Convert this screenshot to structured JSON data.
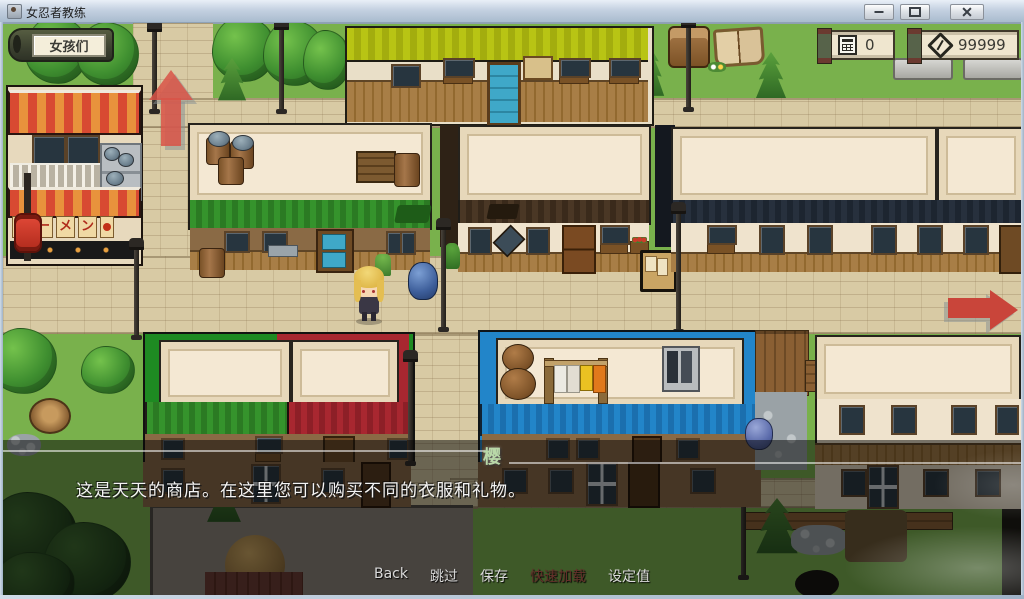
{
  "window": {
    "title": "女忍者教练",
    "controls": {
      "minimize": "minimize",
      "maximize": "maximize",
      "close": "close"
    }
  },
  "hud": {
    "girls_button_label": "女孩们",
    "counters": [
      {
        "name": "points",
        "icon": "calculator-icon",
        "value": "0"
      },
      {
        "name": "gold",
        "icon": "money-icon",
        "value": "99999"
      }
    ]
  },
  "map": {
    "ramen_sign_chars": [
      "ラ",
      "ー",
      "メ",
      "ン"
    ],
    "player": "blonde-girl-sprite",
    "navigation_arrows": [
      "up",
      "right"
    ]
  },
  "dialogue": {
    "speaker": "樱",
    "text": "这是天天的商店。在这里您可以购买不同的衣服和礼物。"
  },
  "menu": {
    "items": [
      {
        "label": "Back",
        "enabled": true
      },
      {
        "label": "跳过",
        "enabled": true
      },
      {
        "label": "保存",
        "enabled": true
      },
      {
        "label": "快速加载",
        "enabled": false
      },
      {
        "label": "设定值",
        "enabled": true
      }
    ]
  },
  "colors": {
    "arrow_red": "#c9453a",
    "hud_parchment": "#efe6cf",
    "overlay": "rgba(8,8,8,0.52)",
    "menu_enabled": "#d9d9d9",
    "menu_disabled": "#63302a",
    "roof_green": "#35932c",
    "roof_blue": "#2285c9",
    "trim_green": "#1e8a22",
    "trim_red": "#a82730",
    "eave_brown": "#4a3725",
    "eave_navy": "#27303d"
  }
}
